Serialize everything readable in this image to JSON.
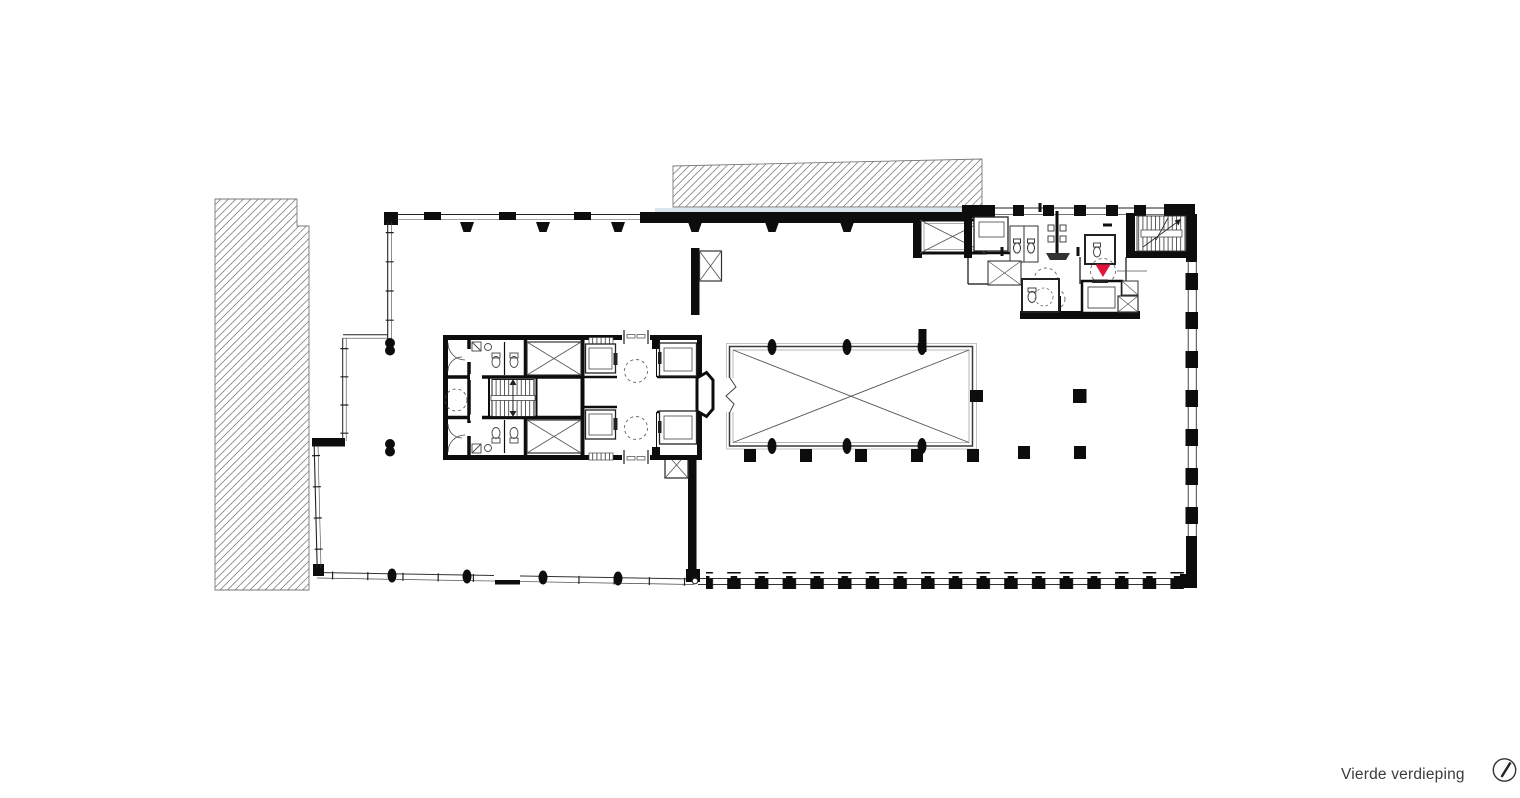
{
  "page": {
    "background": "#ffffff",
    "kind": "architectural floor plan"
  },
  "caption": {
    "floor_label": "Vierde verdieping"
  },
  "colors": {
    "marker_red": "#e2153d",
    "context_strip": "#d9e5ee",
    "wall": "#0d0d0d"
  },
  "icons": {
    "north_arrow": "north-arrow-icon"
  }
}
